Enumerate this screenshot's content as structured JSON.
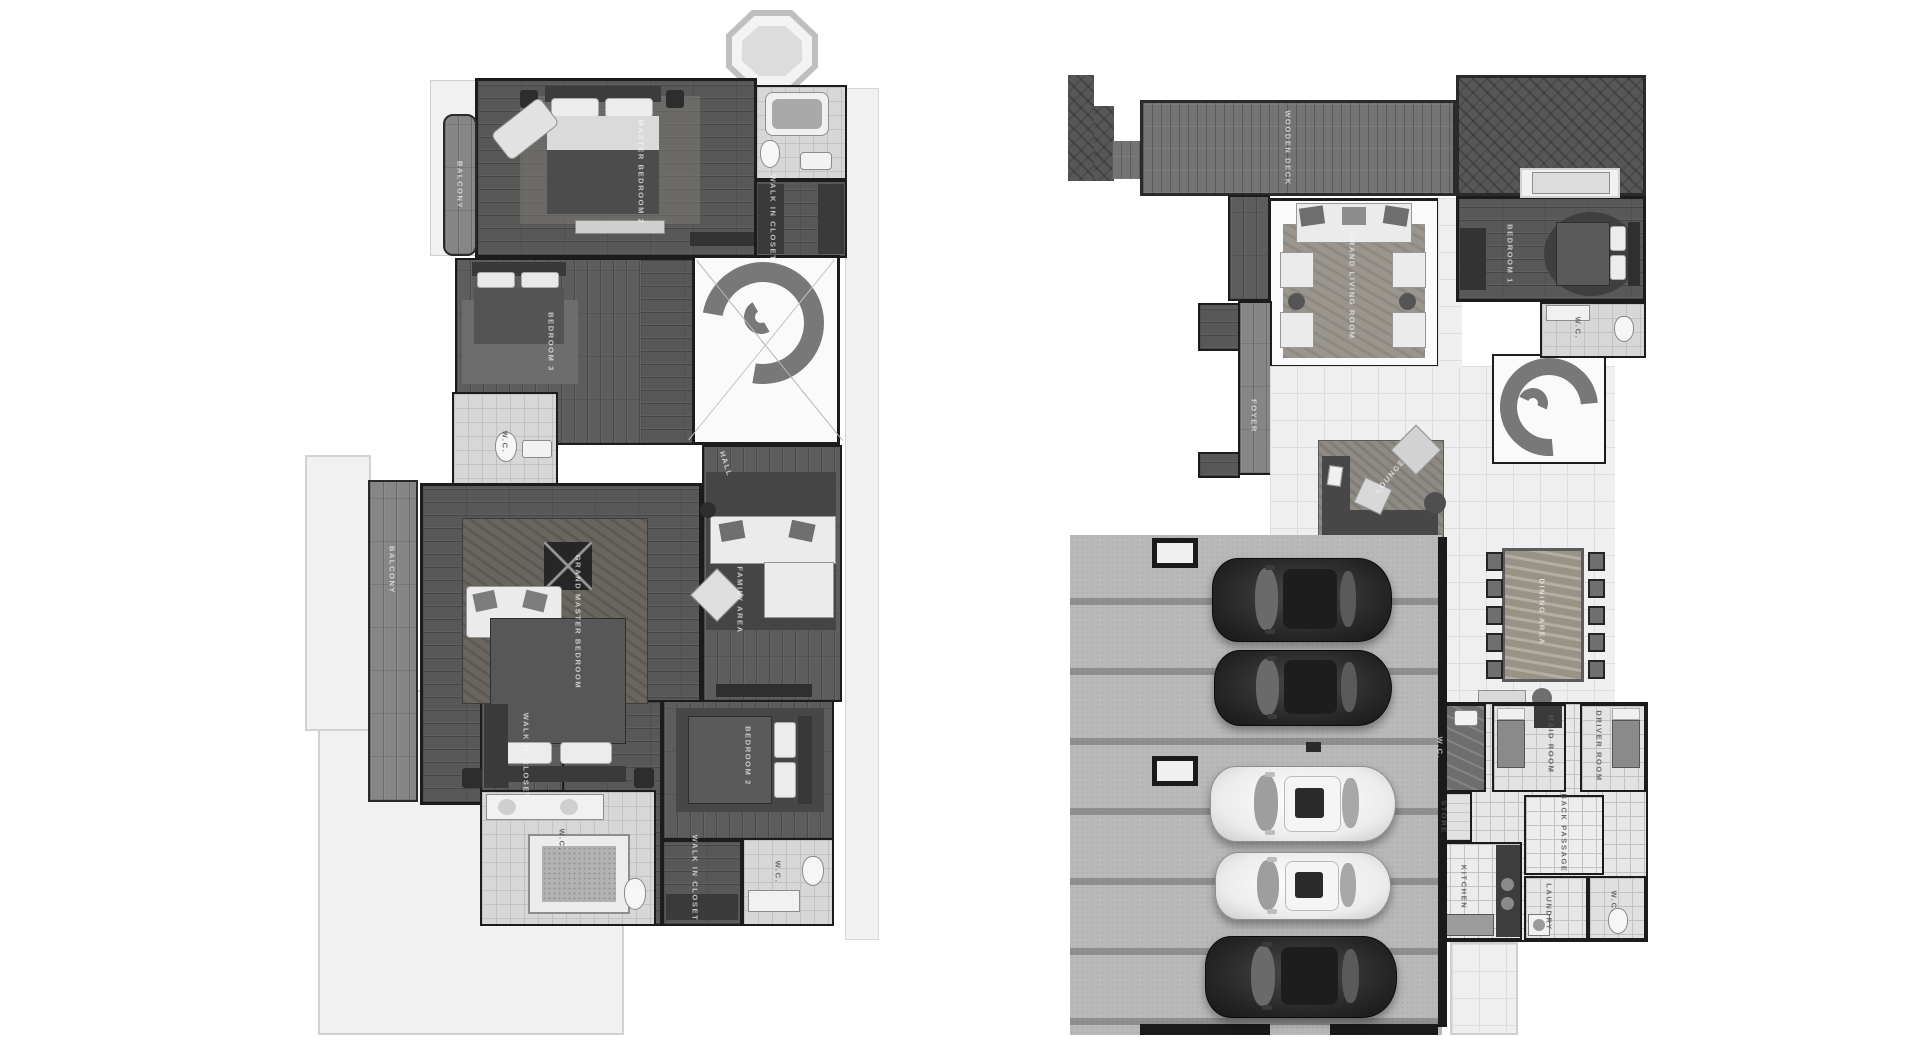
{
  "palette": {
    "background": "#ffffff",
    "wood_floor": "#585858",
    "deck": "#747474",
    "tile_light": "#efefef",
    "tile_bath": "#d7d7d7",
    "paving": "#b9b9b9",
    "walls": "#1a1a1a",
    "label_on_dark": "#f6f6f6",
    "label_on_light": "#555555"
  },
  "plans": {
    "left": {
      "labels": [
        {
          "id": "balcony-upper",
          "text": "BALCONY",
          "x": 460,
          "y": 185,
          "rot": 90,
          "tone": "dark"
        },
        {
          "id": "master-bedroom-2",
          "text": "MASTER BEDROOM 2",
          "x": 641,
          "y": 172,
          "rot": 90,
          "tone": "dark"
        },
        {
          "id": "walk-in-closet-1",
          "text": "WALK IN CLOSET",
          "x": 773,
          "y": 218,
          "rot": 90,
          "tone": "dark"
        },
        {
          "id": "bedroom-3",
          "text": "BEDROOM 3",
          "x": 551,
          "y": 342,
          "rot": 90,
          "tone": "dark"
        },
        {
          "id": "wc-1",
          "text": "W.C.",
          "x": 505,
          "y": 442,
          "rot": 90,
          "tone": "light"
        },
        {
          "id": "balcony-lower",
          "text": "BALCONY",
          "x": 392,
          "y": 570,
          "rot": 90,
          "tone": "dark"
        },
        {
          "id": "grand-master-bedroom",
          "text": "GRAND MASTER BEDROOM",
          "x": 578,
          "y": 622,
          "rot": 90,
          "tone": "dark"
        },
        {
          "id": "hall",
          "text": "HALL",
          "x": 726,
          "y": 464,
          "rot": 72,
          "tone": "dark"
        },
        {
          "id": "family-area",
          "text": "FAMILY AREA",
          "x": 740,
          "y": 600,
          "rot": 90,
          "tone": "dark"
        },
        {
          "id": "walk-in-closet-2",
          "text": "WALK IN CLOSET",
          "x": 526,
          "y": 756,
          "rot": 90,
          "tone": "dark"
        },
        {
          "id": "wc-2",
          "text": "W.C.",
          "x": 562,
          "y": 840,
          "rot": 90,
          "tone": "light"
        },
        {
          "id": "bedroom-2",
          "text": "BEDROOM 2",
          "x": 748,
          "y": 756,
          "rot": 90,
          "tone": "dark"
        },
        {
          "id": "walk-in-closet-3",
          "text": "WALK IN CLOSET",
          "x": 695,
          "y": 878,
          "rot": 90,
          "tone": "dark"
        },
        {
          "id": "wc-3",
          "text": "W.C.",
          "x": 778,
          "y": 872,
          "rot": 90,
          "tone": "light"
        }
      ]
    },
    "right": {
      "labels": [
        {
          "id": "wooden-deck",
          "text": "WOODEN DECK",
          "x": 1288,
          "y": 148,
          "rot": 90,
          "tone": "dark"
        },
        {
          "id": "grand-living-room",
          "text": "GRAND LIVING ROOM",
          "x": 1352,
          "y": 286,
          "rot": 90,
          "tone": "dark"
        },
        {
          "id": "bedroom-1",
          "text": "BEDROOM 1",
          "x": 1510,
          "y": 254,
          "rot": 90,
          "tone": "dark"
        },
        {
          "id": "wc-4",
          "text": "W.C.",
          "x": 1578,
          "y": 328,
          "rot": 90,
          "tone": "light"
        },
        {
          "id": "foyer",
          "text": "FOYER",
          "x": 1254,
          "y": 416,
          "rot": 90,
          "tone": "dark"
        },
        {
          "id": "lounge",
          "text": "LOUNGE",
          "x": 1390,
          "y": 476,
          "rot": -50,
          "tone": "dark"
        },
        {
          "id": "dining-area",
          "text": "DINING AREA",
          "x": 1542,
          "y": 612,
          "rot": 90,
          "tone": "dark"
        },
        {
          "id": "wc-5",
          "text": "W.C.",
          "x": 1440,
          "y": 748,
          "rot": 90,
          "tone": "dark"
        },
        {
          "id": "store",
          "text": "STORE",
          "x": 1444,
          "y": 817,
          "rot": 90,
          "tone": "light"
        },
        {
          "id": "maid-room",
          "text": "MAID ROOM",
          "x": 1551,
          "y": 744,
          "rot": 90,
          "tone": "light"
        },
        {
          "id": "driver-room",
          "text": "DRIVER ROOM",
          "x": 1599,
          "y": 746,
          "rot": 90,
          "tone": "light"
        },
        {
          "id": "kitchen",
          "text": "KITCHEN",
          "x": 1464,
          "y": 887,
          "rot": 90,
          "tone": "light"
        },
        {
          "id": "passage",
          "text": "BACK PASSAGE",
          "x": 1564,
          "y": 833,
          "rot": 90,
          "tone": "light"
        },
        {
          "id": "laundry",
          "text": "LAUNDRY",
          "x": 1549,
          "y": 907,
          "rot": 90,
          "tone": "light"
        },
        {
          "id": "wc-6",
          "text": "W.C.",
          "x": 1614,
          "y": 902,
          "rot": 90,
          "tone": "light"
        }
      ]
    }
  },
  "vehicles": [
    {
      "id": "suv-dark-1",
      "shade": "dark",
      "x": 1212,
      "y": 558,
      "w": 178,
      "h": 82
    },
    {
      "id": "sedan-dark",
      "shade": "dark",
      "x": 1214,
      "y": 650,
      "w": 176,
      "h": 74
    },
    {
      "id": "suv-white",
      "shade": "light",
      "x": 1210,
      "y": 766,
      "w": 184,
      "h": 74
    },
    {
      "id": "sedan-white",
      "shade": "light",
      "x": 1215,
      "y": 852,
      "w": 174,
      "h": 66
    },
    {
      "id": "suv-dark-2",
      "shade": "dark",
      "x": 1205,
      "y": 936,
      "w": 190,
      "h": 80
    }
  ]
}
